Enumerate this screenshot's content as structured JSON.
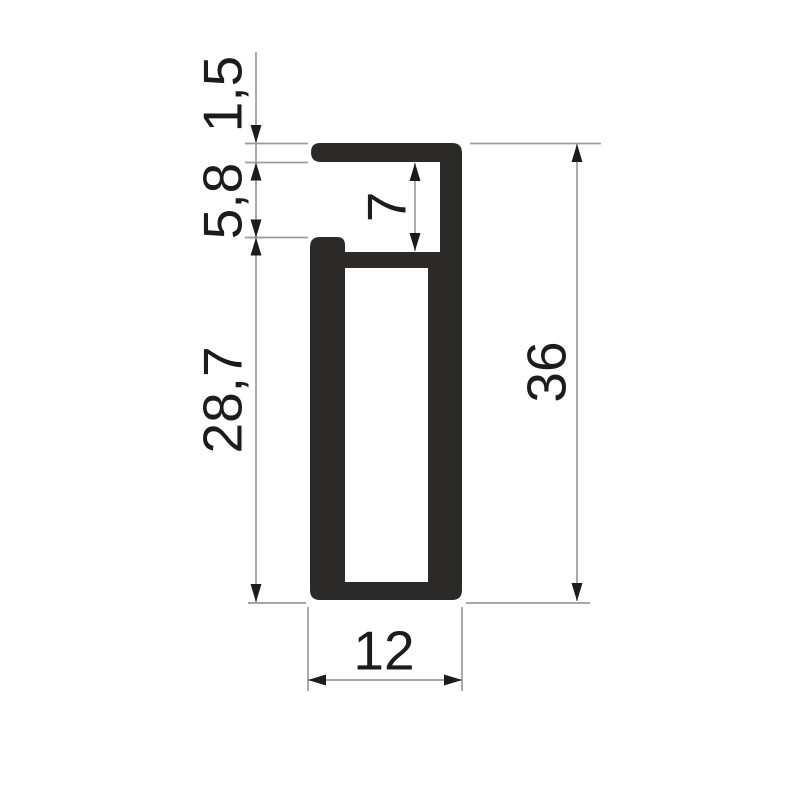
{
  "drawing": {
    "kind": "profile-cross-section-drawing",
    "background_color": "#ffffff",
    "colors": {
      "profile_fill": "#2b2a29",
      "line": "#9c9c9c",
      "arrow": "#1c1c1c",
      "text": "#1c1c1c"
    },
    "dimensions": [
      {
        "label": "1,5",
        "value": 1.5,
        "side": "left",
        "rotated": true
      },
      {
        "label": "5,8",
        "value": 5.8,
        "side": "left",
        "rotated": true
      },
      {
        "label": "28,7",
        "value": 28.7,
        "side": "left",
        "rotated": true
      },
      {
        "label": "7",
        "value": 7,
        "side": "inner",
        "rotated": true
      },
      {
        "label": "36",
        "value": 36,
        "side": "right",
        "rotated": true
      },
      {
        "label": "12",
        "value": 12,
        "side": "bottom",
        "rotated": false
      }
    ]
  }
}
